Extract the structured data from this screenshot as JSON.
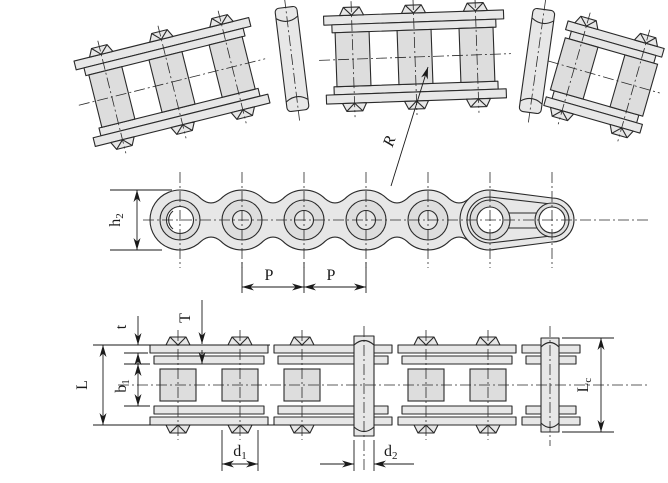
{
  "colors": {
    "background": "#ffffff",
    "fill": "#e7e7e7",
    "roller_fill": "#dddddd",
    "line": "#2a2a2a",
    "dim": "#1a1a1a"
  },
  "views": {
    "bent_view": {
      "labels": {
        "radius": "R"
      }
    },
    "side_view": {
      "labels": {
        "height": {
          "base": "h",
          "sub": "2"
        },
        "pitch": "P"
      }
    },
    "plan_view": {
      "labels": {
        "outer_plate_thickness": "t",
        "inner_plate_thickness": "T",
        "pin_length": "L",
        "inner_width": {
          "base": "b",
          "sub": "1"
        },
        "roller_diameter": {
          "base": "d",
          "sub": "1"
        },
        "pin_diameter": {
          "base": "d",
          "sub": "2"
        },
        "connecting_pin_length": {
          "base": "L",
          "sub": "c"
        }
      }
    }
  }
}
